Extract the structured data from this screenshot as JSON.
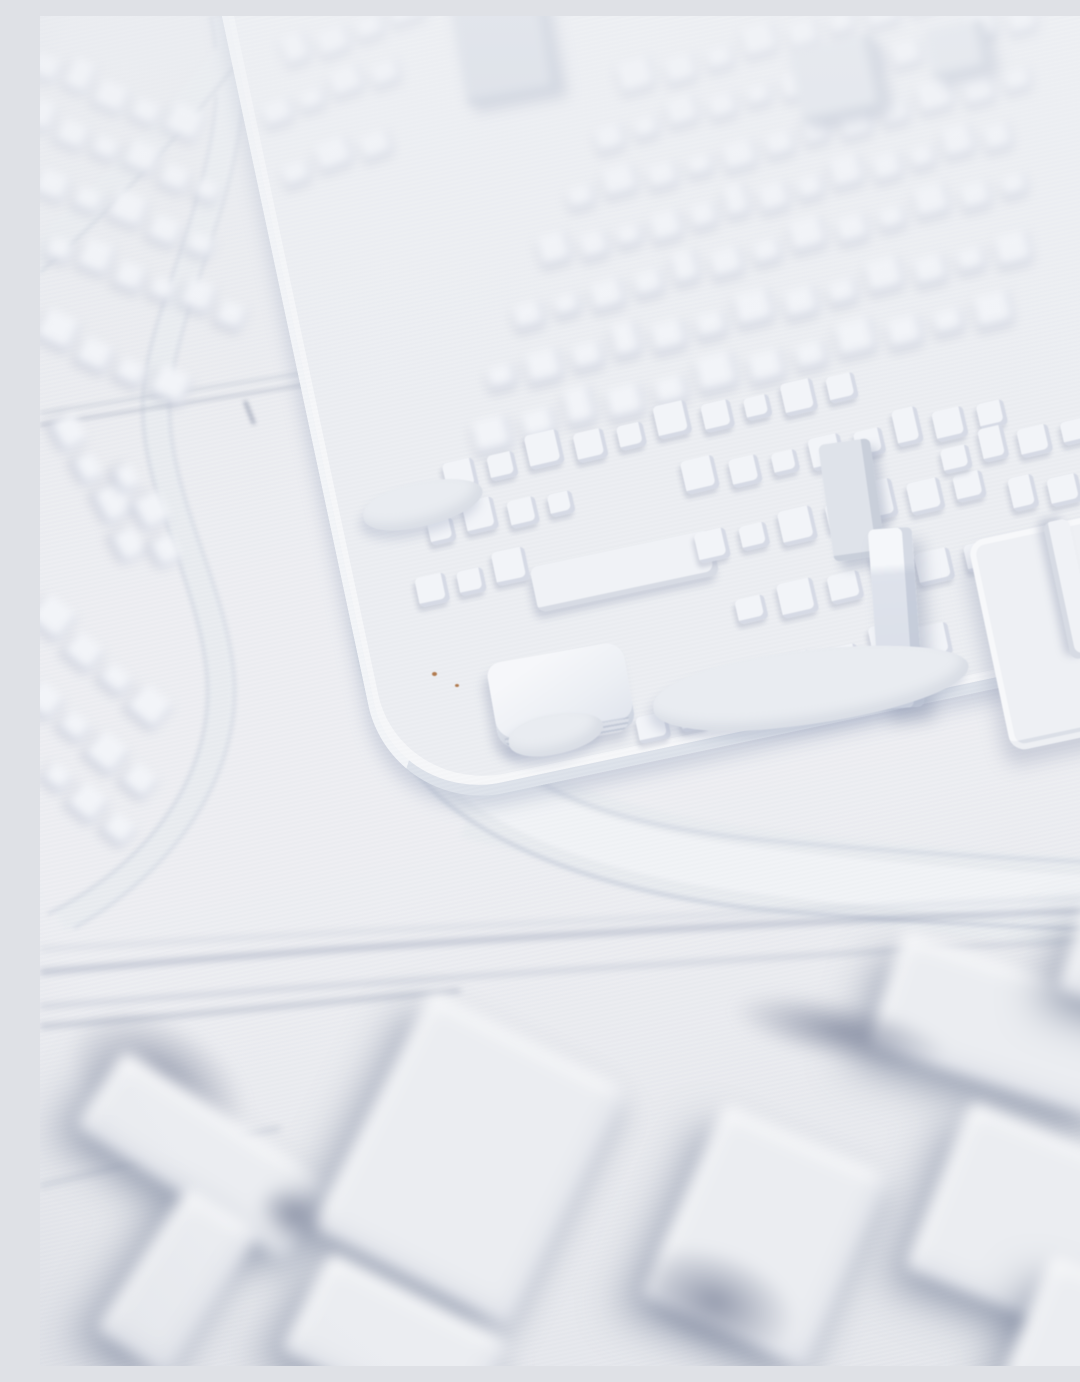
{
  "scene": {
    "description": "White 3D-printed architectural city model photographed at an oblique angle with shallow depth of field; dense rows of small buildings on a raised district plateau, curving highway ridges, and large blurred industrial slabs in the foreground",
    "medium": "photograph",
    "subject": "3d-printed-city-model",
    "lighting": "soft daylight from upper right, bluish shadows toward lower left",
    "focus": "middle band sharp, top and bottom out of focus"
  },
  "palette": {
    "ground_a": "#e7e9ed",
    "ground_b": "#edeef2",
    "ground_c": "#e4e6eb",
    "block_top": "#f2f4f8",
    "block_shade": "#a8b1c4",
    "road_fill": "#e8ebef",
    "road_hi": "#f1f3f6",
    "road_edge": "#c5cbd8",
    "track": "#aab1c2",
    "plateau": "#eceef2",
    "plateau_wall": "#dde2ea",
    "slab": "#ebedf1",
    "mass": "#828b9f",
    "tower_dark": "#d5dae3",
    "tower_mid": "#dfe3ea",
    "blob": "#e9ecf1",
    "speck": "#b07a4e",
    "lane_a": "#a6adc0",
    "lane_b": "#b9bfce",
    "lane_c": "#c6ccd8"
  },
  "blur_px": {
    "top": 4.5,
    "mid": 0.5,
    "roads": 2.2,
    "lanes": 3.5,
    "foreground": 7
  },
  "model": {
    "elements": [
      {
        "kind": "row",
        "layer": "top",
        "name": "row-houses",
        "x": 250,
        "y": 28,
        "rot": -20,
        "count": 4,
        "w": 30,
        "h": 24,
        "gap": 9
      },
      {
        "kind": "row",
        "layer": "top",
        "name": "row-houses",
        "x": 228,
        "y": 88,
        "rot": -20,
        "count": 4,
        "w": 28,
        "h": 22,
        "gap": 9
      },
      {
        "kind": "row",
        "layer": "top",
        "name": "row-houses",
        "x": 248,
        "y": 148,
        "rot": -20,
        "count": 3,
        "w": 30,
        "h": 24,
        "gap": 10
      },
      {
        "kind": "row",
        "layer": "top",
        "name": "row-houses",
        "x": 585,
        "y": 55,
        "rot": -16,
        "count": 11,
        "w": 30,
        "h": 26,
        "gap": 12
      },
      {
        "kind": "row",
        "layer": "top",
        "name": "row-houses",
        "x": 560,
        "y": 112,
        "rot": -16,
        "count": 12,
        "w": 28,
        "h": 24,
        "gap": 11
      },
      {
        "kind": "row",
        "layer": "top",
        "name": "row-houses",
        "x": 532,
        "y": 170,
        "rot": -15,
        "count": 12,
        "w": 30,
        "h": 25,
        "gap": 11
      },
      {
        "kind": "row",
        "layer": "top",
        "name": "row-houses",
        "x": 505,
        "y": 228,
        "rot": -15,
        "count": 13,
        "w": 28,
        "h": 26,
        "gap": 10
      },
      {
        "kind": "row",
        "layer": "top",
        "name": "row-houses",
        "x": 478,
        "y": 288,
        "rot": -15,
        "count": 13,
        "w": 30,
        "h": 26,
        "gap": 12
      },
      {
        "kind": "row",
        "layer": "top",
        "name": "row-houses",
        "x": 452,
        "y": 348,
        "rot": -14,
        "count": 13,
        "w": 32,
        "h": 28,
        "gap": 12
      },
      {
        "kind": "row",
        "layer": "top",
        "name": "row-houses",
        "x": 438,
        "y": 406,
        "rot": -14,
        "count": 12,
        "w": 34,
        "h": 30,
        "gap": 13
      },
      {
        "kind": "row",
        "layer": "top",
        "name": "row-houses",
        "x": -12,
        "y": 30,
        "rot": 24,
        "count": 5,
        "w": 30,
        "h": 26,
        "gap": 8
      },
      {
        "kind": "row",
        "layer": "top",
        "name": "row-houses",
        "x": -14,
        "y": 86,
        "rot": 23,
        "count": 6,
        "w": 28,
        "h": 24,
        "gap": 8
      },
      {
        "kind": "row",
        "layer": "top",
        "name": "row-houses",
        "x": -6,
        "y": 148,
        "rot": 22,
        "count": 5,
        "w": 30,
        "h": 26,
        "gap": 9
      },
      {
        "kind": "row",
        "layer": "top",
        "name": "row-houses",
        "x": 4,
        "y": 214,
        "rot": 21,
        "count": 6,
        "w": 28,
        "h": 26,
        "gap": 8
      },
      {
        "kind": "row",
        "layer": "top",
        "name": "row-houses",
        "x": -6,
        "y": 295,
        "rot": 26,
        "count": 4,
        "w": 32,
        "h": 28,
        "gap": 9
      },
      {
        "kind": "row",
        "layer": "top",
        "name": "row-houses",
        "x": 10,
        "y": 380,
        "rot": 62,
        "count": 4,
        "w": 32,
        "h": 28,
        "gap": 10
      },
      {
        "kind": "row",
        "layer": "top",
        "name": "row-houses",
        "x": 70,
        "y": 430,
        "rot": 62,
        "count": 3,
        "w": 30,
        "h": 26,
        "gap": 10
      },
      {
        "kind": "row",
        "layer": "top",
        "name": "row-houses",
        "x": -14,
        "y": 575,
        "rot": 40,
        "count": 4,
        "w": 34,
        "h": 30,
        "gap": 10
      },
      {
        "kind": "row",
        "layer": "top",
        "name": "row-houses",
        "x": -16,
        "y": 655,
        "rot": 40,
        "count": 4,
        "w": 32,
        "h": 30,
        "gap": 10
      },
      {
        "kind": "row",
        "layer": "top",
        "name": "row-houses",
        "x": 0,
        "y": 735,
        "rot": 40,
        "count": 3,
        "w": 30,
        "h": 28,
        "gap": 10
      },
      {
        "kind": "tower",
        "layer": "top",
        "name": "high-rise-block",
        "x": 418,
        "y": -18,
        "w": 95,
        "h": 100,
        "rot": -10,
        "bg": "tower_dark"
      },
      {
        "kind": "tower",
        "layer": "top",
        "name": "high-rise-block",
        "x": 755,
        "y": 25,
        "w": 85,
        "h": 75,
        "rot": -12,
        "bg": "tower_mid"
      },
      {
        "kind": "tower",
        "layer": "top",
        "name": "high-rise-block",
        "x": 888,
        "y": 8,
        "w": 60,
        "h": 50,
        "rot": -12,
        "bg": "tower_mid"
      },
      {
        "kind": "row",
        "layer": "mid",
        "name": "row-houses",
        "x": 408,
        "y": 446,
        "rot": -13,
        "count": 10,
        "w": 30,
        "h": 30,
        "gap": 13
      },
      {
        "kind": "row",
        "layer": "mid",
        "name": "row-houses",
        "x": 392,
        "y": 502,
        "rot": -13,
        "count": 4,
        "w": 28,
        "h": 28,
        "gap": 12
      },
      {
        "kind": "slabv",
        "layer": "mid",
        "name": "long-bar-building",
        "x": 492,
        "y": 532,
        "w": 185,
        "h": 46,
        "rot": -12
      },
      {
        "kind": "row",
        "layer": "mid",
        "name": "row-houses",
        "x": 380,
        "y": 560,
        "rot": -12,
        "count": 3,
        "w": 30,
        "h": 30,
        "gap": 11
      },
      {
        "kind": "bigblock",
        "layer": "mid",
        "name": "courtyard-block",
        "x": 452,
        "y": 636,
        "w": 138,
        "h": 88,
        "rot": -10
      },
      {
        "kind": "row",
        "layer": "mid",
        "name": "row-houses",
        "x": 648,
        "y": 452,
        "rot": -13,
        "count": 8,
        "w": 30,
        "h": 30,
        "gap": 13
      },
      {
        "kind": "row",
        "layer": "mid",
        "name": "row-houses",
        "x": 660,
        "y": 515,
        "rot": -13,
        "count": 7,
        "w": 32,
        "h": 32,
        "gap": 13
      },
      {
        "kind": "row",
        "layer": "mid",
        "name": "row-houses",
        "x": 700,
        "y": 578,
        "rot": -13,
        "count": 6,
        "w": 34,
        "h": 32,
        "gap": 14
      },
      {
        "kind": "row",
        "layer": "mid",
        "name": "row-houses",
        "x": 740,
        "y": 640,
        "rot": -12,
        "count": 4,
        "w": 34,
        "h": 32,
        "gap": 14
      },
      {
        "kind": "row",
        "layer": "mid",
        "name": "row-houses",
        "x": 905,
        "y": 430,
        "rot": -13,
        "count": 4,
        "w": 30,
        "h": 28,
        "gap": 12
      },
      {
        "kind": "row",
        "layer": "mid",
        "name": "row-houses",
        "x": 975,
        "y": 470,
        "rot": -13,
        "count": 3,
        "w": 30,
        "h": 28,
        "gap": 12
      },
      {
        "kind": "row",
        "layer": "mid",
        "name": "row-houses",
        "x": 600,
        "y": 700,
        "rot": -12,
        "count": 3,
        "w": 30,
        "h": 26,
        "gap": 12
      },
      {
        "kind": "tower",
        "layer": "mid",
        "name": "slab-tower",
        "x": 786,
        "y": 425,
        "w": 52,
        "h": 118,
        "rot": -8,
        "bg": "tower_mid"
      },
      {
        "kind": "towerTall",
        "layer": "mid",
        "name": "tall-tower",
        "x": 834,
        "y": 512,
        "w": 44,
        "h": 180,
        "rot": -4
      },
      {
        "kind": "terrace",
        "layer": "mid",
        "name": "raised-terrace",
        "x": 948,
        "y": 508,
        "w": 150,
        "h": 215,
        "rot": -12
      },
      {
        "kind": "slabv",
        "layer": "mid",
        "name": "terrace-slab",
        "x": 960,
        "y": 560,
        "w": 140,
        "h": 26,
        "rot": 78
      },
      {
        "kind": "slabv",
        "layer": "mid",
        "name": "terrace-slab",
        "x": 1010,
        "y": 570,
        "w": 150,
        "h": 28,
        "rot": 80
      },
      {
        "kind": "blob",
        "layer": "mid",
        "name": "tree-canopy-pad",
        "x": 612,
        "y": 634,
        "w": 318,
        "h": 74,
        "rot": -7
      },
      {
        "kind": "blob",
        "layer": "mid",
        "name": "tree-canopy-pad",
        "x": 322,
        "y": 466,
        "w": 122,
        "h": 44,
        "rot": -12
      },
      {
        "kind": "blob",
        "layer": "mid",
        "name": "tree-canopy-pad",
        "x": 468,
        "y": 698,
        "w": 96,
        "h": 40,
        "rot": -10
      },
      {
        "kind": "speck",
        "layer": "mid",
        "name": "dust-speck",
        "x": 392,
        "y": 656,
        "w": 5,
        "h": 4,
        "rot": 0
      },
      {
        "kind": "speck",
        "layer": "mid",
        "name": "dust-speck",
        "x": 415,
        "y": 668,
        "w": 4,
        "h": 3,
        "rot": 0
      },
      {
        "kind": "mass",
        "layer": "fore",
        "name": "shadow-mass",
        "x": 20,
        "y": 1005,
        "w": 195,
        "h": 120,
        "rot": 30
      },
      {
        "kind": "slab",
        "layer": "fore",
        "name": "industrial-slab",
        "x": 40,
        "y": 1095,
        "w": 250,
        "h": 90,
        "rot": 33
      },
      {
        "kind": "slab",
        "layer": "fore",
        "name": "industrial-slab",
        "x": 95,
        "y": 1180,
        "w": 85,
        "h": 170,
        "rot": 33
      },
      {
        "kind": "slab",
        "layer": "fore",
        "name": "industrial-slab",
        "x": 320,
        "y": 1010,
        "w": 220,
        "h": 265,
        "rot": 27
      },
      {
        "kind": "slab",
        "layer": "fore",
        "name": "industrial-slab",
        "x": 255,
        "y": 1275,
        "w": 200,
        "h": 110,
        "rot": 27
      },
      {
        "kind": "slab",
        "layer": "fore",
        "name": "industrial-slab",
        "x": 635,
        "y": 1115,
        "w": 180,
        "h": 210,
        "rot": 24
      },
      {
        "kind": "slab",
        "layer": "fore",
        "name": "industrial-slab",
        "x": 840,
        "y": 950,
        "w": 250,
        "h": 120,
        "rot": 18
      },
      {
        "kind": "slab",
        "layer": "fore",
        "name": "industrial-slab",
        "x": 1030,
        "y": 895,
        "w": 95,
        "h": 95,
        "rot": 18
      },
      {
        "kind": "slab",
        "layer": "fore",
        "name": "industrial-slab",
        "x": 890,
        "y": 1120,
        "w": 225,
        "h": 180,
        "rot": 22
      },
      {
        "kind": "slab",
        "layer": "fore",
        "name": "industrial-slab",
        "x": 980,
        "y": 1265,
        "w": 170,
        "h": 140,
        "rot": 22
      },
      {
        "kind": "mass",
        "layer": "fore",
        "name": "shadow-mass",
        "x": 590,
        "y": 1235,
        "w": 170,
        "h": 100,
        "rot": 20
      },
      {
        "kind": "mass",
        "layer": "fore",
        "name": "shadow-mass",
        "x": 215,
        "y": 1170,
        "w": 75,
        "h": 55,
        "rot": 25
      },
      {
        "kind": "mass",
        "layer": "fore",
        "name": "shadow-mass",
        "x": 690,
        "y": 985,
        "w": 220,
        "h": 60,
        "rot": 12
      }
    ]
  }
}
